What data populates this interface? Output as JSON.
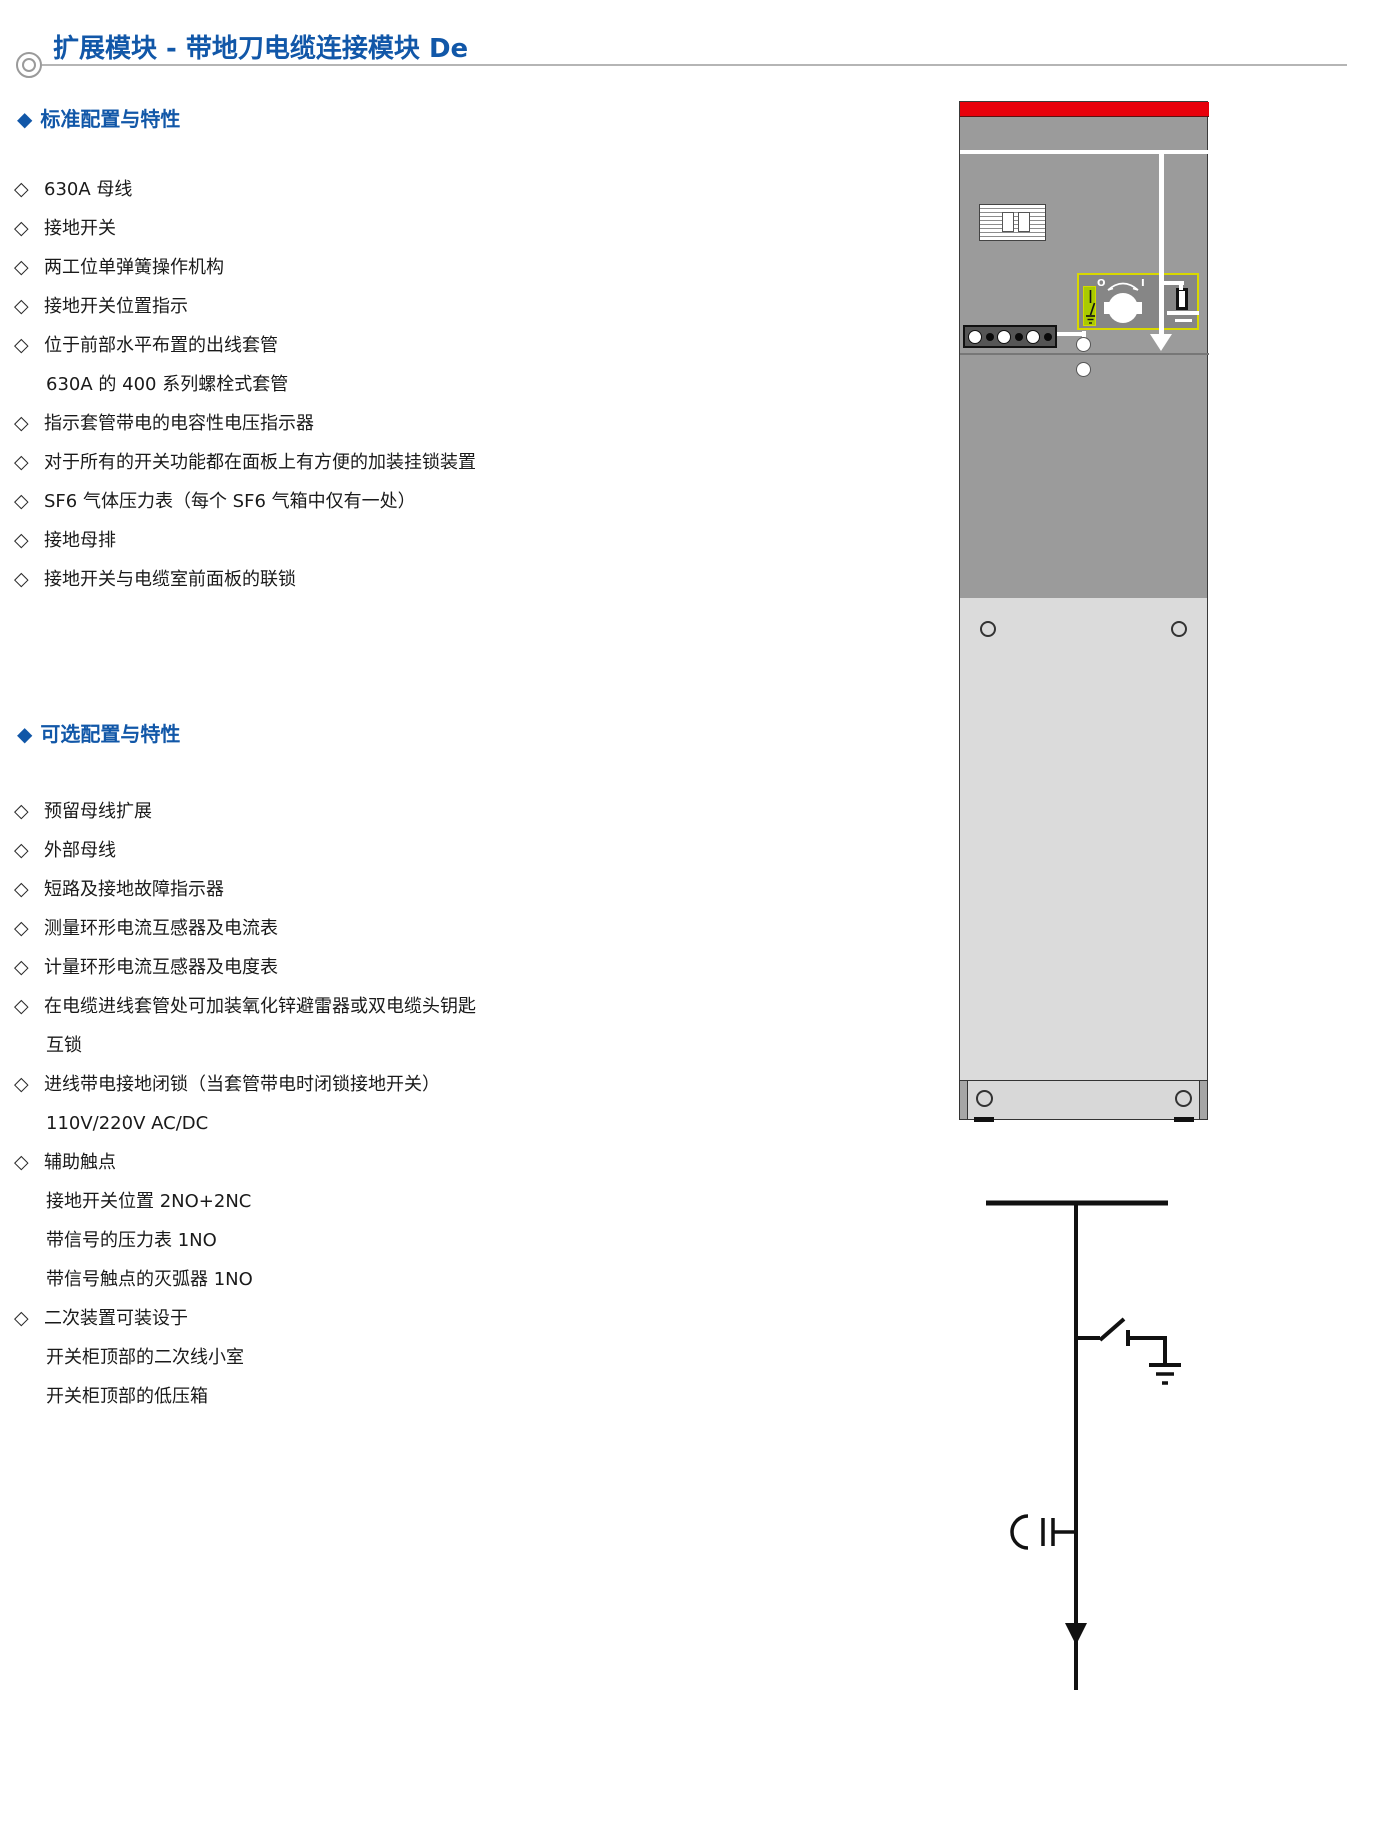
{
  "page": {
    "title": "扩展模块 - 带地刀电缆连接模块 De"
  },
  "icons": {
    "heading_diamond": "◆",
    "item_diamond": "◇"
  },
  "sections": {
    "standard": {
      "heading": "标准配置与特性",
      "items": [
        {
          "bullet": true,
          "text": "630A 母线"
        },
        {
          "bullet": true,
          "text": "接地开关"
        },
        {
          "bullet": true,
          "text": "两工位单弹簧操作机构"
        },
        {
          "bullet": true,
          "text": "接地开关位置指示"
        },
        {
          "bullet": true,
          "text": "位于前部水平布置的出线套管"
        },
        {
          "bullet": false,
          "text": "630A 的 400 系列螺栓式套管"
        },
        {
          "bullet": true,
          "text": "指示套管带电的电容性电压指示器"
        },
        {
          "bullet": true,
          "text": "对于所有的开关功能都在面板上有方便的加装挂锁装置"
        },
        {
          "bullet": true,
          "text": "SF6 气体压力表（每个 SF6 气箱中仅有一处）"
        },
        {
          "bullet": true,
          "text": "接地母排"
        },
        {
          "bullet": true,
          "text": "接地开关与电缆室前面板的联锁"
        }
      ]
    },
    "optional": {
      "heading": "可选配置与特性",
      "items": [
        {
          "bullet": true,
          "text": "预留母线扩展"
        },
        {
          "bullet": true,
          "text": "外部母线"
        },
        {
          "bullet": true,
          "text": "短路及接地故障指示器"
        },
        {
          "bullet": true,
          "text": "测量环形电流互感器及电流表"
        },
        {
          "bullet": true,
          "text": "计量环形电流互感器及电度表"
        },
        {
          "bullet": true,
          "text": "在电缆进线套管处可加装氧化锌避雷器或双电缆头钥匙"
        },
        {
          "bullet": false,
          "text": "互锁"
        },
        {
          "bullet": true,
          "text": "进线带电接地闭锁（当套管带电时闭锁接地开关）"
        },
        {
          "bullet": false,
          "text": "110V/220V AC/DC"
        },
        {
          "bullet": true,
          "text": "辅助触点"
        },
        {
          "bullet": false,
          "text": "接地开关位置 2NO+2NC"
        },
        {
          "bullet": false,
          "text": "带信号的压力表 1NO"
        },
        {
          "bullet": false,
          "text": "带信号触点的灭弧器 1NO"
        },
        {
          "bullet": true,
          "text": "二次装置可装设于"
        },
        {
          "bullet": false,
          "text": "开关柜顶部的二次线小室"
        },
        {
          "bullet": false,
          "text": "开关柜顶部的低压箱"
        }
      ]
    }
  },
  "cabinet": {
    "knob_off_label": "O",
    "knob_on_label": "I",
    "colors": {
      "red_band": "#e8000b",
      "body_gray": "#9b9b9b",
      "door_gray": "#dbdbdb",
      "panel_border_yellow": "#d8d800",
      "indicator_green": "#a9cb00"
    }
  },
  "schematic": {
    "elements": [
      "busbar",
      "earthing-switch",
      "earth-symbol",
      "capacitive-voltage-indicator",
      "cable-feeder-arrow"
    ],
    "line_color": "#111111"
  }
}
